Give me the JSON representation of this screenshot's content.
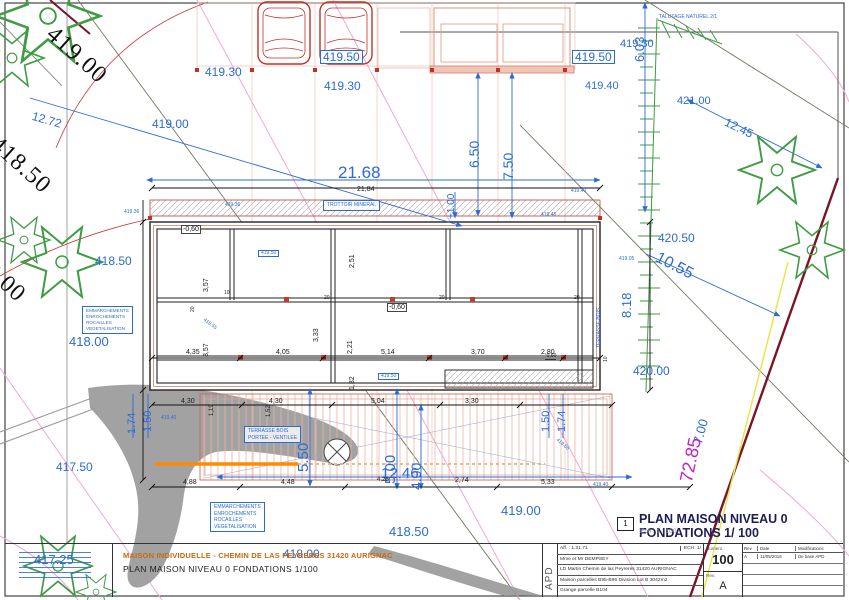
{
  "colors": {
    "annotation_blue": "#2b6bd6",
    "dimension_black": "#1a1a1a",
    "magenta": "#c320c3",
    "terrain_gray": "#9a9a9a",
    "vegetation_green": "#3f9b44",
    "axis_salmon": "#f0b8a8",
    "boundary_darkred": "#7a1525",
    "boundary_yellow": "#e6e64e",
    "orange_line": "#ff8a00",
    "title_orange": "#c96a10"
  },
  "contours": [
    "419.00",
    "418.50",
    "8.00"
  ],
  "blue": [
    "419.30",
    "419.00",
    "12.72",
    "419.50",
    "419.30",
    "419.50",
    "419.40",
    "6.03",
    "419.30",
    "421.00",
    "12.45",
    "21.68",
    "6.50",
    "7.50",
    "420.50",
    "10.55",
    "8.18",
    "420.00",
    "7.00",
    "418.50",
    "418.00",
    "417.50",
    "1.74",
    "1.50",
    "1.50",
    "1.74",
    "5.50",
    "5.00",
    "4.00",
    "+1.00",
    "12.46",
    "419.00",
    "418.50",
    "418.00",
    "417.25",
    "419.36",
    "419.45",
    "419.40",
    "419.05",
    "418.55",
    "419.60",
    "419.40",
    "419.40",
    "419.36",
    "419.50",
    "419.50",
    "TERRASSE BOIS",
    "TALUTAGE NATUREL 2/1"
  ],
  "black": [
    "21,84",
    "4,35",
    "4,05",
    "5,14",
    "3,70",
    "2,80",
    "3,57",
    "2,51",
    "3,57",
    "3,33",
    "2,21",
    "1,32",
    "-0,60",
    "-0,60",
    "-0,60",
    "4,30",
    "4,30",
    "5,04",
    "3,30",
    "1,19",
    "1,52",
    "4,88",
    "4,48",
    "4,28",
    "2,74",
    "5,33"
  ],
  "tiny": [
    "20",
    "10",
    "20",
    "20",
    "20",
    "10"
  ],
  "magenta_labels": [
    "72.85"
  ],
  "notes": {
    "trottoir": "TROTTOIR MINERAL",
    "emmarchements": "EMMARCHEMENTS\nENROCHEMENTS\nROCAILLES\nVEGETALISATION",
    "terrasse": "TERRASSE BOIS\nPORTEE - VENTILEE"
  },
  "title": {
    "number": "1",
    "label": "PLAN MAISON NIVEAU 0 FONDATIONS 1/ 100",
    "scale": "Ech :  1 : 100"
  },
  "cartouche": {
    "project_title": "MAISON INDIVIDUELLE - CHEMIN DE LAS PEYRERES 31420 AURIGNAC",
    "sheet_title": "PLAN MAISON NIVEAU 0 FONDATIONS 1/100",
    "phase": "APD",
    "ref": "Aff. : 1.31.71",
    "ech": "ECH: 1/",
    "client": "Mme et Mr DEMPSEY",
    "address": "LD Martin Chemin de las Peyreres 31420 AURIGNAC",
    "parcels": "Maison parcelles B95-B96 Division Lot B 3042m2",
    "barn": "Grange parcelle B104",
    "numero_label": "Numero",
    "numero": "100",
    "rev_label": "Rev.",
    "rev": "A",
    "table": {
      "h": [
        "Rev",
        "Date",
        "Modifications"
      ],
      "r": [
        "A",
        "11/05/2016",
        "De base APD"
      ]
    }
  }
}
